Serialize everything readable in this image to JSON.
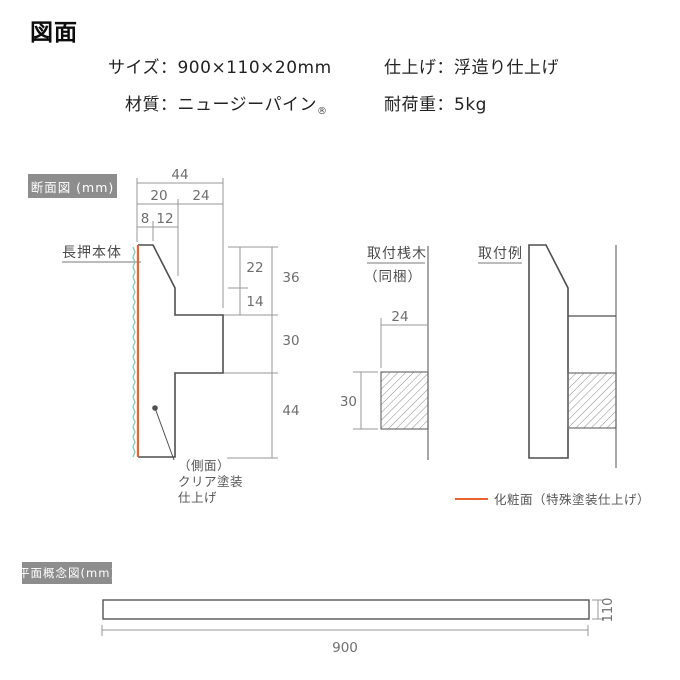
{
  "header": {
    "title": "図面",
    "size": "サイズ：900×110×20mm",
    "finish": "仕上げ：浮造り仕上げ",
    "material": "材質：ニュージーパイン",
    "material_reg": "®",
    "load": "耐荷重：5kg"
  },
  "cross_section": {
    "label": "断面図 (mm)",
    "part_name": "長押本体",
    "dims": {
      "total_top_width": "44",
      "front_thickness": "20",
      "rear_depth": "24",
      "top_flat": "8",
      "slope_run": "12",
      "slope_drop": "22",
      "below_slope": "14",
      "upper_section": "36",
      "flange_height": "30",
      "lower_section": "44"
    },
    "side_note_line1": "（側面）",
    "side_note_line2": "クリア塗装",
    "side_note_line3": "仕上げ"
  },
  "batten": {
    "name": "取付桟木",
    "included": "（同梱）",
    "width": "24",
    "height": "30"
  },
  "install_example": {
    "name": "取付例"
  },
  "legend": {
    "label": "化粧面（特殊塗装仕上げ）",
    "line_color": "#e8632e"
  },
  "plan_view": {
    "label": "平面概念図(mm)",
    "length": "900",
    "height": "110"
  },
  "colors": {
    "decorative_face": "#e8632e",
    "texture_wave": "#7fccbf",
    "outline": "#4f4f4f",
    "dimension": "#979797",
    "section_label_bg": "#8d8d8d"
  }
}
